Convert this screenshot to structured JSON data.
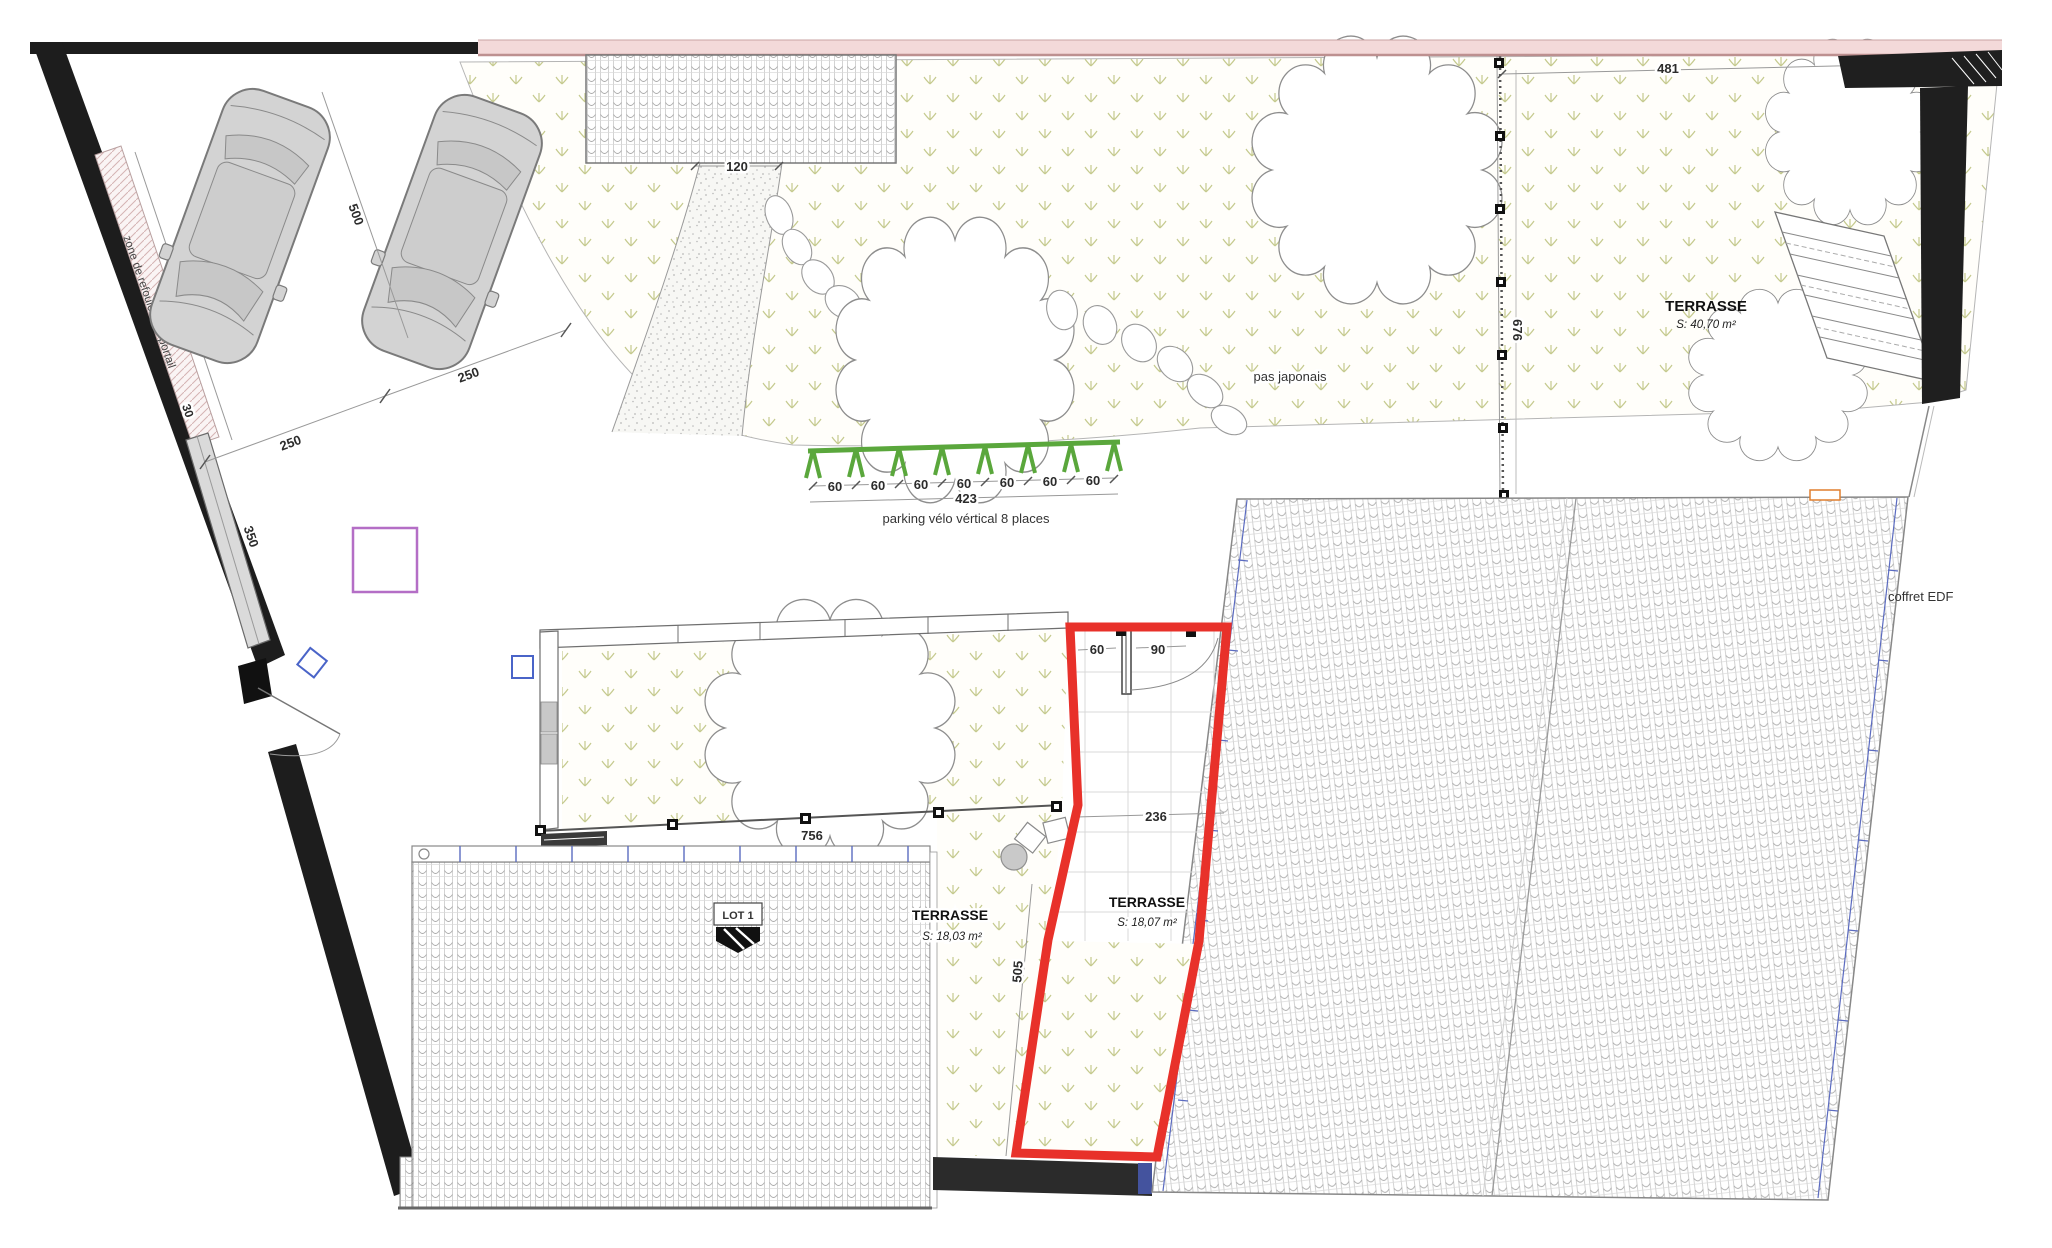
{
  "labels": {
    "zone_portail": "zone de refoulement portail",
    "pas_japonais": "pas japonais",
    "parking_velo": "parking vélo vértical 8 places",
    "coffret_edf": "coffret EDF",
    "lot1": "LOT 1"
  },
  "terraces": {
    "north": {
      "title": "TERRASSE",
      "area": "S: 40,70 m²"
    },
    "west": {
      "title": "TERRASSE",
      "area": "S: 18,03 m²"
    },
    "east": {
      "title": "TERRASSE",
      "area": "S: 18,07 m²"
    }
  },
  "dims": {
    "d380": "380",
    "d30": "30",
    "d350": "350",
    "d500": "500",
    "d250a": "250",
    "d250b": "250",
    "d120": "120",
    "d481": "481",
    "d676": "676",
    "d423": "423",
    "d756": "756",
    "d236": "236",
    "d505": "505",
    "bike_space": "60",
    "strip_door": "60",
    "red_door_left": "60",
    "red_door_right": "90"
  },
  "colors": {
    "highlight_red": "#e8312a",
    "bike_green": "#5aa73c",
    "band_pink": "#f3d9d9",
    "marker_purple": "#b46ec6",
    "marker_blue": "#4a64c8",
    "gutter_blue": "#5b6bc0",
    "coffret_orange": "#e07f2e",
    "grass_olive": "#c5ca8e"
  }
}
